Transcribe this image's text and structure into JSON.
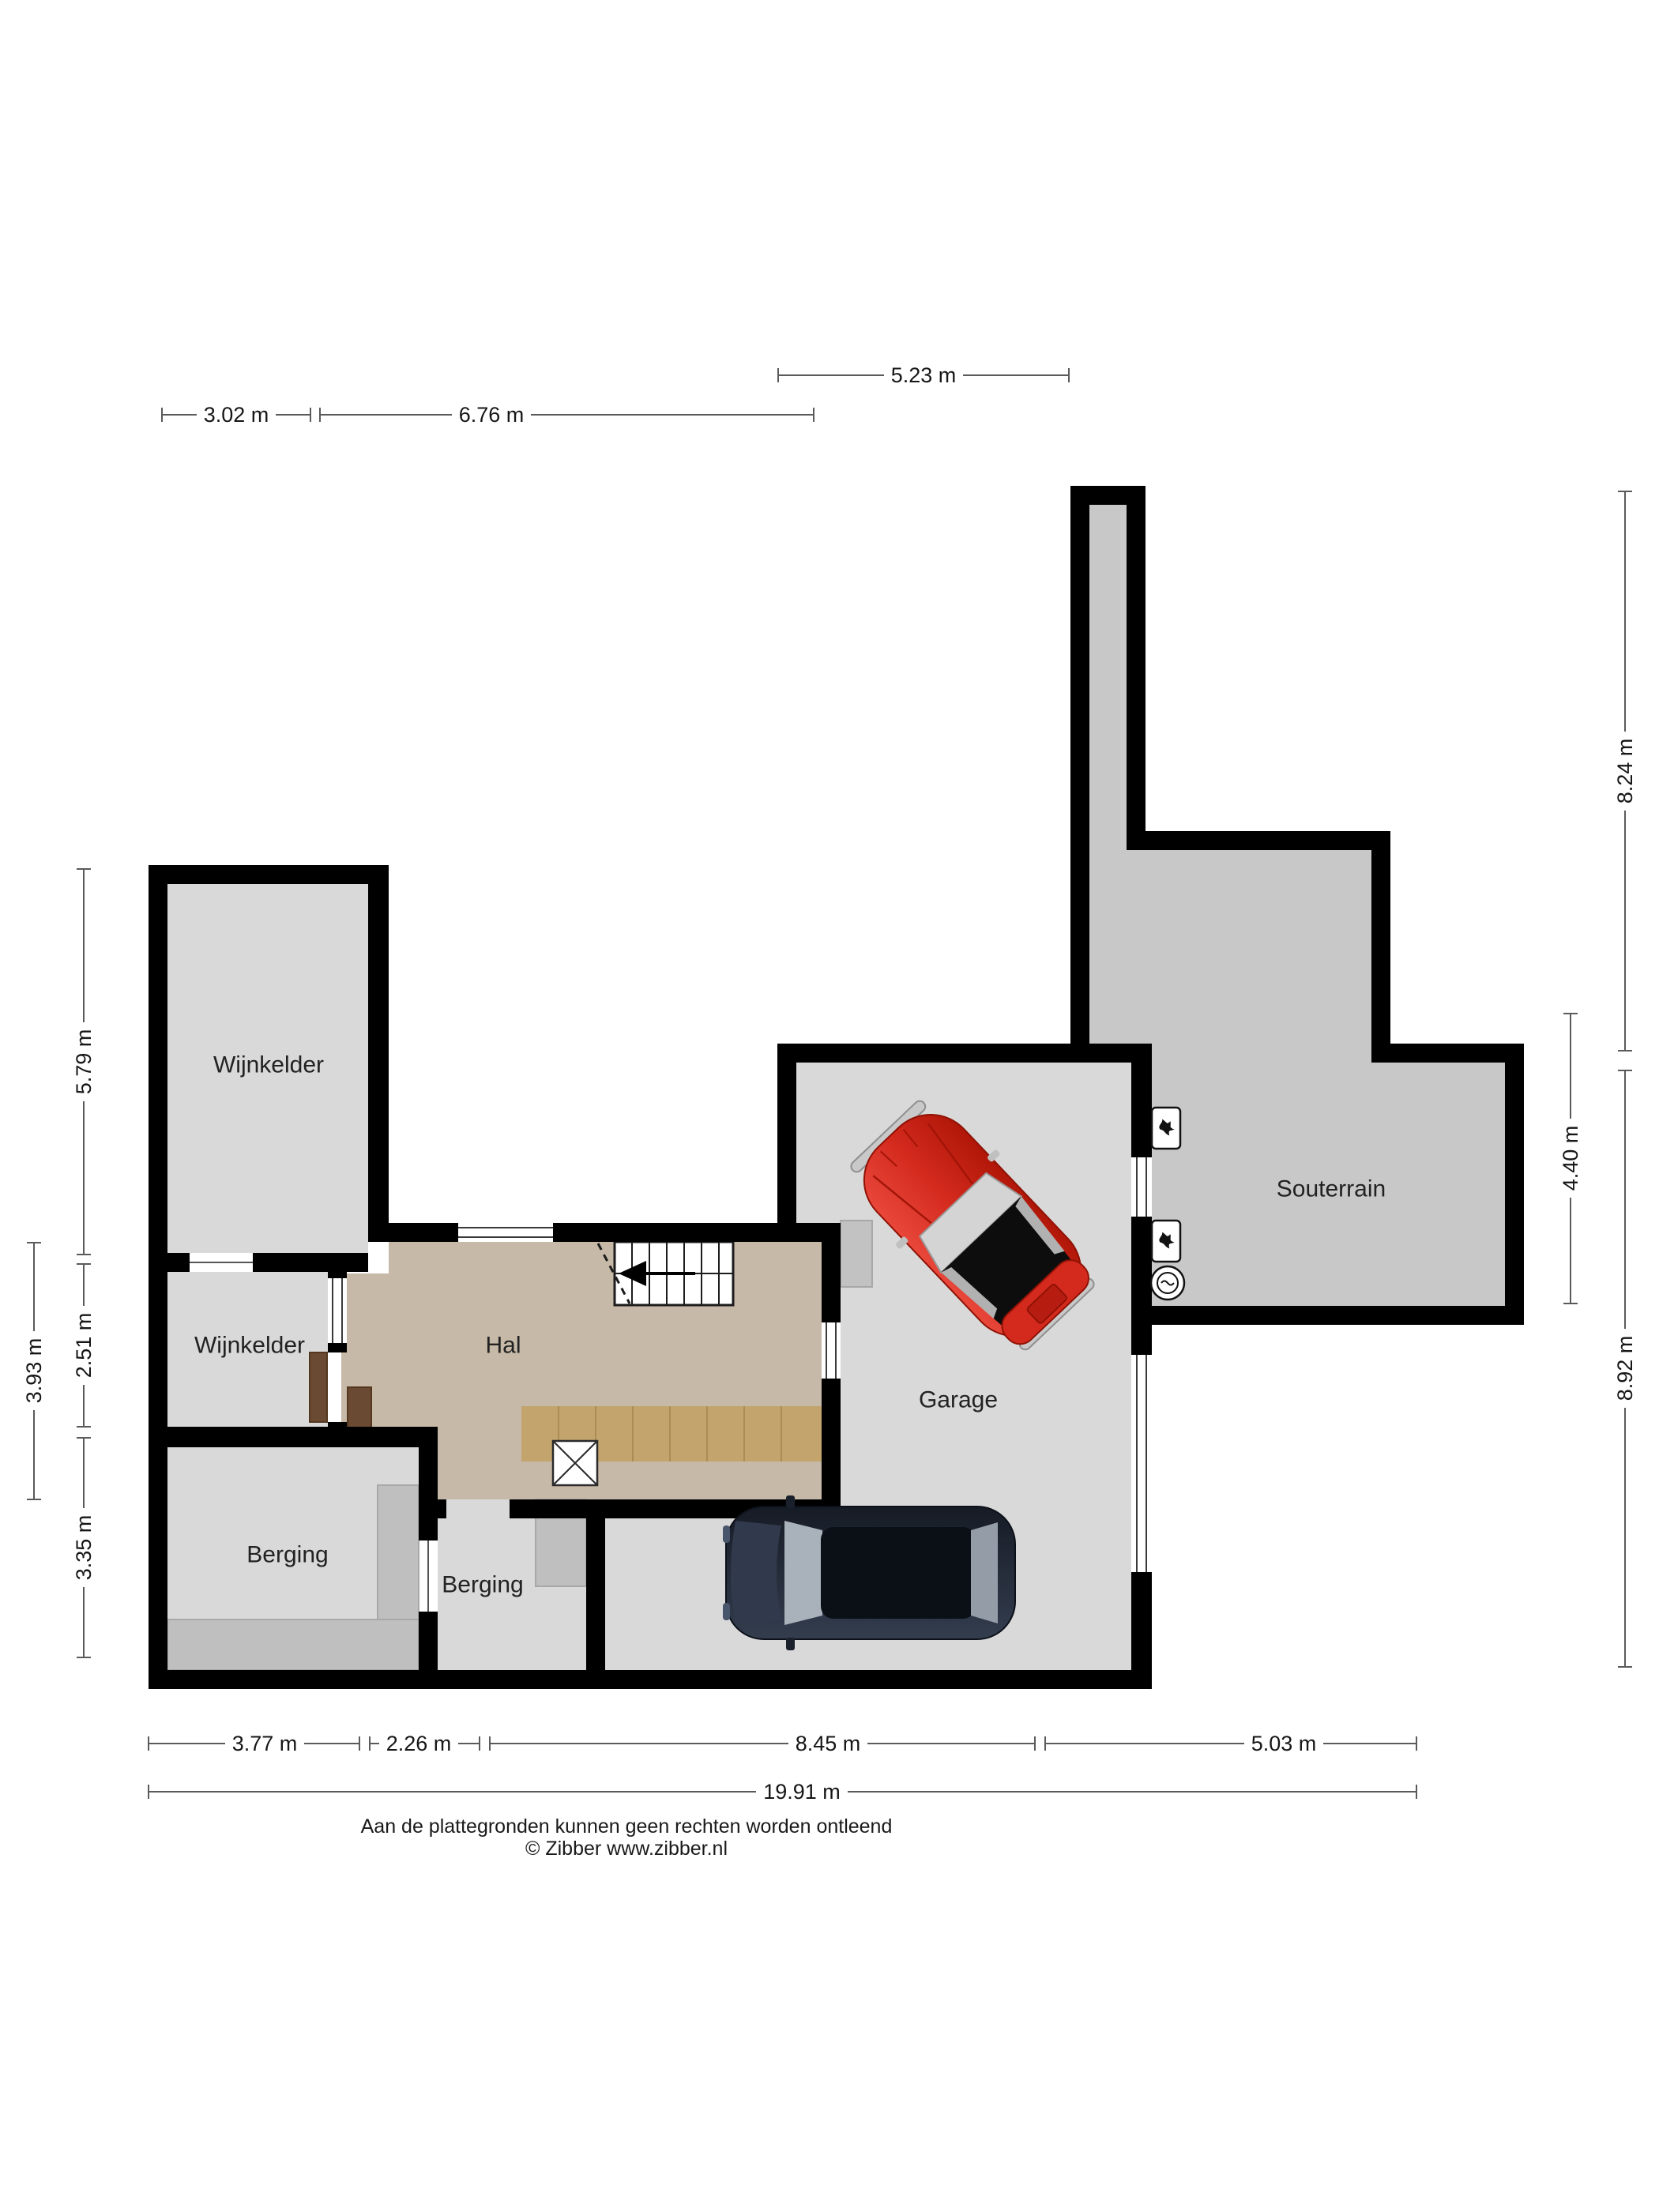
{
  "plan": {
    "title": "basement floor plan",
    "rooms": {
      "wijnkelder_1": "Wijnkelder",
      "wijnkelder_2": "Wijnkelder",
      "hal": "Hal",
      "berging_1": "Berging",
      "berging_2": "Berging",
      "garage": "Garage",
      "souterrain": "Souterrain"
    },
    "dimensions": {
      "top_wijnkelder_width": "3.02 m",
      "top_hal_width": "6.76 m",
      "top_garage_width": "5.23 m",
      "right_entry_height": "8.24 m",
      "right_souterrain_height": "4.40 m",
      "right_garage_height": "8.92 m",
      "left_wijnkelder_1_height": "5.79 m",
      "left_hal_height": "3.93 m",
      "left_wijnkelder_2_height": "2.51 m",
      "left_berging_height": "3.35 m",
      "bottom_berging_1_width": "3.77 m",
      "bottom_berging_2_width": "2.26 m",
      "bottom_garage_width": "8.45 m",
      "bottom_souterrain_width": "5.03 m",
      "bottom_total_width": "19.91 m"
    },
    "icons": {
      "boiler_1": "boiler-flame-icon",
      "boiler_2": "boiler-flame-icon",
      "meter": "round-meter-icon",
      "stairs": "staircase-up-arrow",
      "void": "shaft-cross"
    },
    "colors": {
      "wall": "#000000",
      "room_floor": "#d9d9d9",
      "souterrain_floor": "#c8c8c8",
      "hal_floor": "#c7b9a7",
      "wood_floor": "#c3a46c",
      "furniture": "#bfbfbf",
      "car_red": "#d42a1e",
      "car_dark": "#252c3a"
    },
    "footer": {
      "disclaimer": "Aan de plattegronden kunnen geen rechten worden ontleend",
      "copyright": "© Zibber www.zibber.nl"
    }
  }
}
